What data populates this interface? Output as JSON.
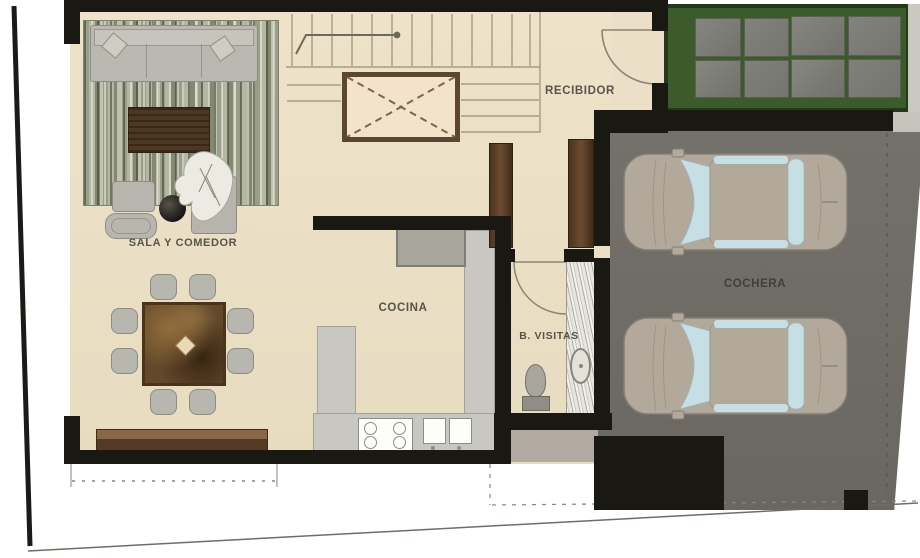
{
  "rooms": [
    {
      "id": "sala-y-comedor",
      "label": "SALA Y COMEDOR"
    },
    {
      "id": "cocina",
      "label": "COCINA"
    },
    {
      "id": "recibidor",
      "label": "RECIBIDOR"
    },
    {
      "id": "bano-visitas",
      "label": "B. VISITAS"
    },
    {
      "id": "cochera",
      "label": "COCHERA"
    }
  ],
  "colors": {
    "wall": "#191813",
    "floor_beige": "#ebdfc7",
    "garage_floor": "#6f6c66",
    "lawn_green": "#3b5b2b",
    "paver_gray": "#7d7e78",
    "wood_brown": "#5d4128",
    "counter_gray": "#c8c7c1",
    "car_body": "#b3a99b",
    "car_glass": "#c6dfe5",
    "elevator_shaft_border": "#5a4632"
  }
}
